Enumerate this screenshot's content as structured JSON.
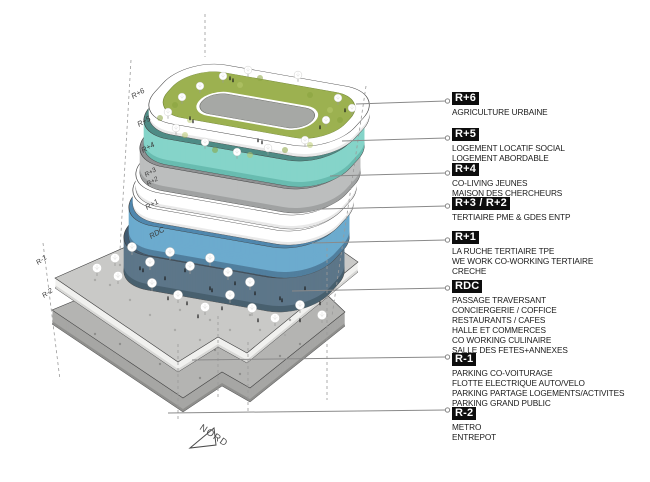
{
  "diagram": {
    "type": "exploded-axonometric-building-program",
    "north_label": "NORD"
  },
  "legend": {
    "items": [
      {
        "code": "R+6",
        "lines": [
          "AGRICULTURE URBAINE"
        ]
      },
      {
        "code": "R+5",
        "lines": [
          "LOGEMENT LOCATIF SOCIAL",
          "LOGEMENT ABORDABLE"
        ]
      },
      {
        "code": "R+4",
        "lines": [
          "CO-LIVING JEUNES",
          "MAISON DES CHERCHEURS"
        ]
      },
      {
        "code": "R+3 / R+2",
        "lines": [
          "TERTIAIRE PME & GDES ENTP"
        ]
      },
      {
        "code": "R+1",
        "lines": [
          "LA RUCHE TERTIAIRE TPE",
          "WE WORK CO-WORKING TERTIAIRE",
          "CRECHE"
        ]
      },
      {
        "code": "RDC",
        "lines": [
          "PASSAGE TRAVERSANT",
          "CONCIERGERIE / COFFICE",
          "RESTAURANTS / CAFES",
          "HALLE ET COMMERCES",
          "CO WORKING CULINAIRE",
          "SALLE DES FETES+ANNEXES"
        ]
      },
      {
        "code": "R-1",
        "lines": [
          "PARKING CO-VOITURAGE",
          "FLOTTE ELECTRIQUE AUTO/VELO",
          "PARKING PARTAGE LOGEMENTS/ACTIVITES",
          "PARKING GRAND PUBLIC"
        ]
      },
      {
        "code": "R-2",
        "lines": [
          "METRO",
          "ENTREPOT"
        ]
      }
    ]
  },
  "floor_tags": [
    "R+6",
    "R+5",
    "R+4",
    "R+3",
    "R+2",
    "R+1",
    "RDC",
    "R-1",
    "R-2"
  ],
  "colors": {
    "grass": "#9cb150",
    "grass_dark": "#88a23e",
    "grass_light": "#b8c96e",
    "courtyard": "#a6a8a5",
    "teal_top": "#4e8b85",
    "teal_side": "#85d4c9",
    "teal_shade": "#68bcb0",
    "gray_top": "#8e9092",
    "gray_side": "#bcbebe",
    "gray_shade": "#a0a2a2",
    "blue_top": "#4f87ae",
    "blue_side": "#6cabce",
    "blue_shade": "#517f9e",
    "slate_top": "#415a70",
    "slate_side": "#5d7689",
    "slate_shade": "#48606f",
    "white_floor": "#ffffff",
    "white_shade": "#e9e9e9",
    "concrete_top": "#c9c9c7",
    "concrete_side": "#f1f1ef",
    "concrete_shade": "#d8d8d6",
    "concrete2_top": "#b4b4b2",
    "concrete2_side": "#a6a6a4",
    "concrete2_shade": "#8f8f8d",
    "badge_bg": "#0d0d0d",
    "badge_text": "#ffffff",
    "leader": "#8a8a8a",
    "dashed": "#9a9a9a"
  }
}
